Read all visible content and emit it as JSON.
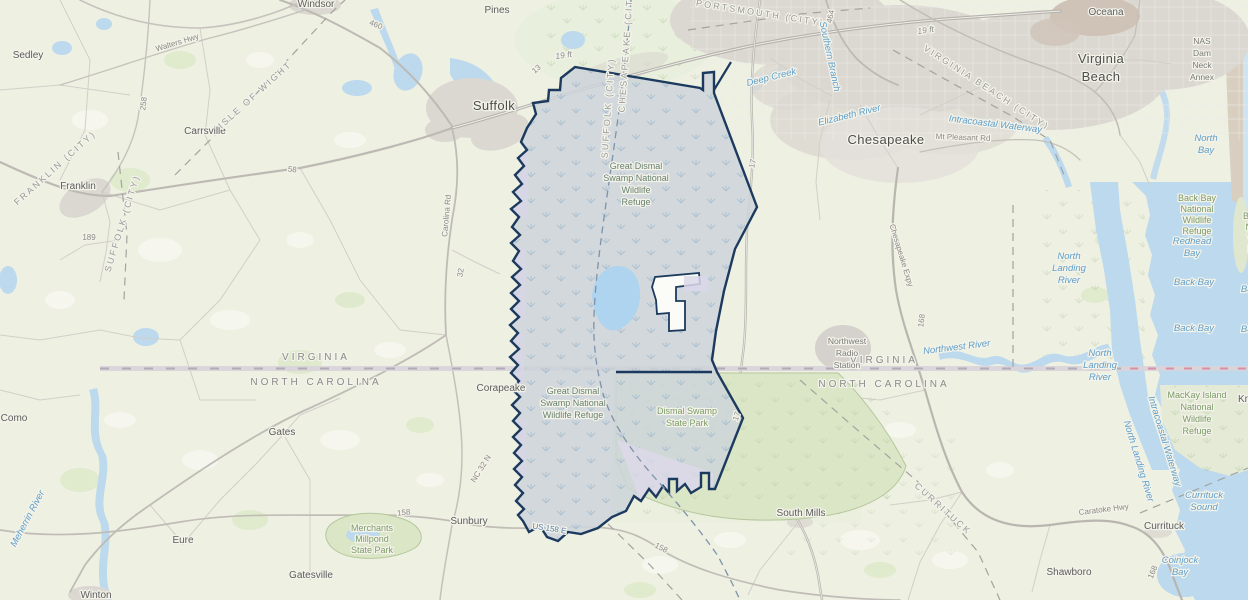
{
  "map": {
    "description": "Topographic web-map of the Great Dismal Swamp area on the Virginia / North Carolina border",
    "colors": {
      "basemap": "#eef0e2",
      "refuge_fill": "#ccd3d9",
      "refuge_outline": "#1c3a5e",
      "state_park_fill": "#dbe6c6",
      "water": "#bcd9ee",
      "urban": "#dbd7d1",
      "lavender_tract": "#d9d5e8",
      "state_line": "#d8d4da",
      "water_label": "#5f9ec9",
      "park_label": "#7d9b68"
    }
  },
  "labels": {
    "cities": {
      "suffolk": "Suffolk",
      "chesapeake": "Chesapeake",
      "virginia_beach": [
        "Virginia",
        "Beach"
      ],
      "franklin": "Franklin"
    },
    "towns": {
      "sedley": "Sedley",
      "carrsville": "Carrsville",
      "windsor": "Windsor",
      "pines": "Pines",
      "como": "Como",
      "eure": "Eure",
      "gates": "Gates",
      "gatesville": "Gatesville",
      "winton": "Winton",
      "sunbury": "Sunbury",
      "corapeake": "Corapeake",
      "south_mills": "South Mills",
      "shawboro": "Shawboro",
      "currituck": "Currituck",
      "knotts_island": "Knotts Island",
      "oceana": "Oceana"
    },
    "counties": {
      "isle_of_wight": "ISLE OF WIGHT",
      "franklin_city": "FRANKLIN (CITY)",
      "suffolk_city": "SUFFOLK (CITY)",
      "chesapeake_city": "CHESAPEAKE (CITY)",
      "portsmouth_city": "PORTSMOUTH (CITY)",
      "virginia_beach_city": "VIRGINIA BEACH (CITY)",
      "currituck_co": "CURRITUCK"
    },
    "states": {
      "virginia": "VIRGINIA",
      "north_carolina": "NORTH CAROLINA"
    },
    "parks": {
      "gdsnwr_n": [
        "Great Dismal",
        "Swamp National",
        "Wildlife",
        "Refuge"
      ],
      "gdsnwr_s": [
        "Great Dismal",
        "Swamp National",
        "Wildlife Refuge"
      ],
      "dismal_sp": [
        "Dismal Swamp",
        "State Park"
      ],
      "back_bay_nwr": [
        "Back Bay",
        "National",
        "Wildlife",
        "Refuge"
      ],
      "mackay": [
        "MacKay Island",
        "National",
        "Wildlife",
        "Refuge"
      ],
      "merchants": [
        "Merchants",
        "Millpond",
        "State Park"
      ]
    },
    "water": {
      "meherrin": "Meherrin River",
      "elizabeth": "Elizabeth River",
      "southern_branch": "Southern Branch",
      "deep_creek": "Deep Creek",
      "intracoastal": "Intracoastal Waterway",
      "northwest_river": "Northwest River",
      "north_landing": [
        "North",
        "Landing",
        "River"
      ],
      "north_landing_full": "North Landing River",
      "back_bay": "Back Bay",
      "redhead_bay": [
        "Redhead",
        "Bay"
      ],
      "north_bay": [
        "North",
        "Bay"
      ],
      "currituck_sound": [
        "Currituck",
        "Sound"
      ],
      "coinjock_bay": [
        "Coinjock",
        "Bay"
      ]
    },
    "roads": {
      "walters": "Walters Hwy",
      "carolina_rd": "Carolina Rd",
      "mt_pleasant": "Mt Pleasant Rd",
      "chesapeake_expy": "Chesapeake Expy",
      "caratoke": "Caratoke Hwy",
      "nc_32": "NC 32 N",
      "us_158_e": "US 158 E",
      "r460": "460",
      "r258": "258",
      "r58": "58",
      "r189": "189",
      "r13": "13",
      "r17": "17",
      "r32": "32",
      "r158": "158",
      "r168": "168",
      "r464": "464"
    },
    "annotations": {
      "spot_elevation": "19 ft",
      "nas": [
        "NAS",
        "Dam",
        "Neck",
        "Annex"
      ],
      "nw_radio": [
        "Northwest",
        "Radio",
        "Station"
      ]
    }
  }
}
